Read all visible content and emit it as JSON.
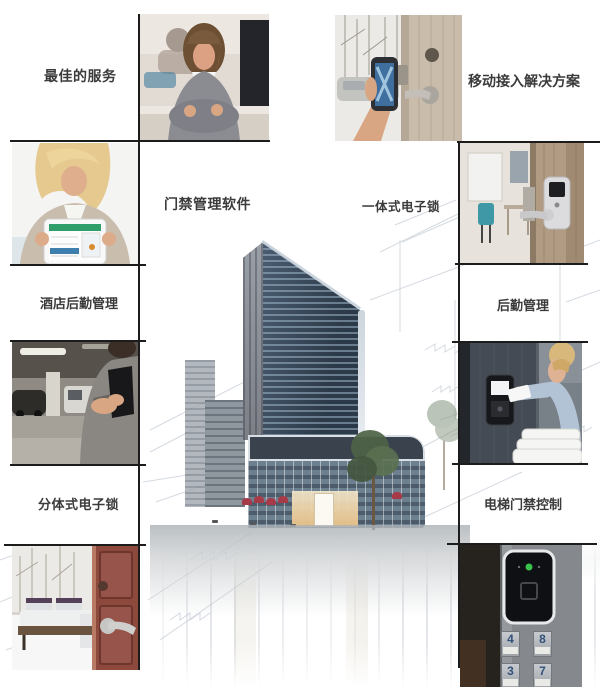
{
  "labels": {
    "best_service": "最佳的服务",
    "mobile_access": "移动接入解决方案",
    "access_software": "门禁管理软件",
    "integrated_lock": "一体式电子锁",
    "hotel_backoffice": "酒店后勤管理",
    "backoffice": "后勤管理",
    "split_lock": "分体式电子锁",
    "elevator_access": "电梯门禁控制"
  },
  "elevator_buttons": [
    "4",
    "8",
    "3",
    "7"
  ],
  "colors": {
    "separator_line": "#1c1c1c",
    "label_text": "#3b3b3b",
    "led_green": "#3ac24e",
    "umbrella_red": "#a63a49",
    "tower_glass": "#33404f"
  }
}
